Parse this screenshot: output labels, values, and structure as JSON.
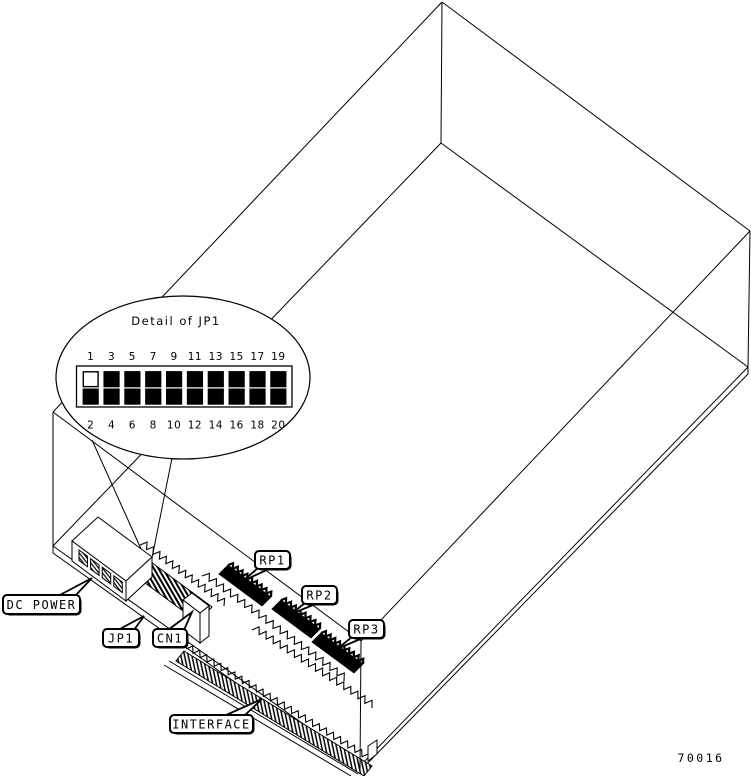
{
  "detail_callout": {
    "title": "Detail of JP1",
    "pins_top": [
      "1",
      "3",
      "5",
      "7",
      "9",
      "11",
      "13",
      "15",
      "17",
      "19"
    ],
    "pins_bottom": [
      "2",
      "4",
      "6",
      "8",
      "10",
      "12",
      "14",
      "16",
      "18",
      "20"
    ],
    "open_pins": [
      "1"
    ]
  },
  "labels": {
    "dc_power": "DC POWER",
    "jp1": "JP1",
    "cn1": "CN1",
    "rp1": "RP1",
    "rp2": "RP2",
    "rp3": "RP3",
    "interface": "INTERFACE"
  },
  "figure_number": "70016",
  "colors": {
    "ink": "#000000",
    "paper": "#ffffff"
  }
}
